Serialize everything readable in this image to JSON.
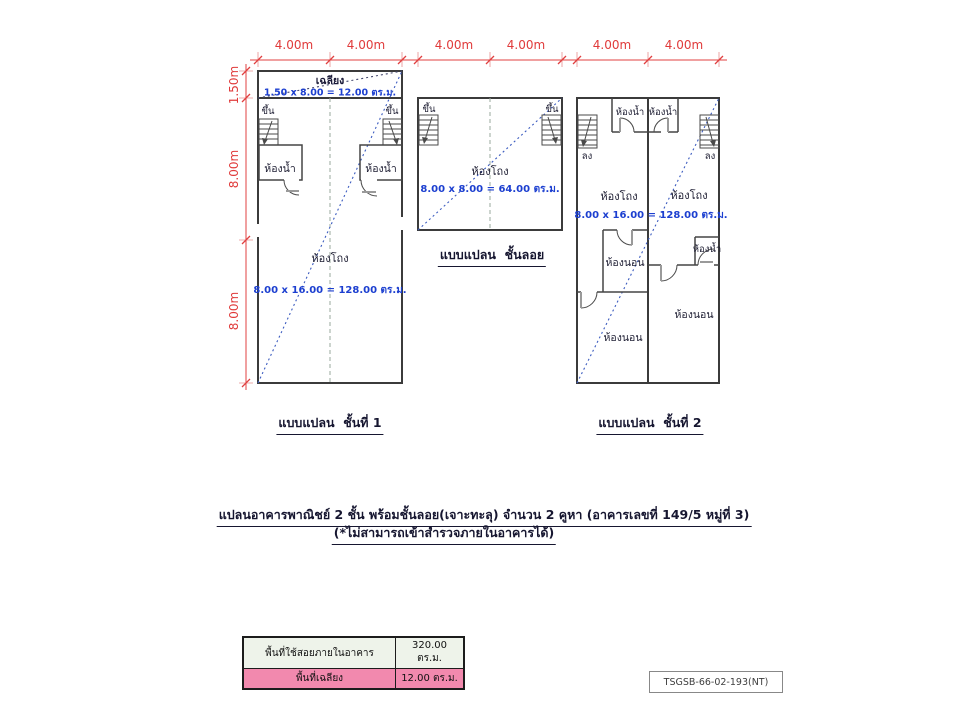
{
  "colors": {
    "plan_fill": "#e3f0e6",
    "porch_fill": "#ee87ae",
    "dimension_red": "#e04040",
    "area_text_blue": "#1c3fd0",
    "wall_dark": "#3b3b3b",
    "diagonal_blue": "#3c5cc0",
    "table_row_building_bg": "#eef3ea",
    "table_row_porch_bg": "#f289ae"
  },
  "dimensions": {
    "floor1": {
      "top": [
        "4.00m",
        "4.00m"
      ],
      "left": [
        "1.50m",
        "8.00m",
        "8.00m"
      ]
    },
    "mezzanine": {
      "top": [
        "4.00m",
        "4.00m"
      ]
    },
    "floor2": {
      "top": [
        "4.00m",
        "4.00m"
      ]
    }
  },
  "plans": {
    "floor1": {
      "caption": "แบบแปลน  ชั้นที่ 1",
      "porch_label": "เฉลียง",
      "porch_area": "1.50 x 8.00 = 12.00 ตร.ม.",
      "stair_up_left": "ขึ้น",
      "stair_up_right": "ขึ้น",
      "bathroom_left": "ห้องน้ำ",
      "bathroom_right": "ห้องน้ำ",
      "hall": "ห้องโถง",
      "hall_area": "8.00 x 16.00 = 128.00 ตร.ม."
    },
    "mezzanine": {
      "caption": "แบบแปลน  ชั้นลอย",
      "stair_up_left": "ขึ้น",
      "stair_up_right": "ขึ้น",
      "hall": "ห้องโถง",
      "hall_area": "8.00 x 8.00 = 64.00 ตร.ม."
    },
    "floor2": {
      "caption": "แบบแปลน  ชั้นที่ 2",
      "stair_down_left": "ลง",
      "stair_down_right": "ลง",
      "bathroom_top_left": "ห้องน้ำ",
      "bathroom_top_right": "ห้องน้ำ",
      "hall_left": "ห้องโถง",
      "hall_right": "ห้องโถง",
      "hall_area": "8.00 x 16.00 = 128.00 ตร.ม.",
      "bedroom_left_upper": "ห้องนอน",
      "bedroom_left_lower": "ห้องนอน",
      "bedroom_right": "ห้องนอน",
      "bathroom_right_small": "ห้องน้ำ"
    }
  },
  "title": {
    "line1": "แปลนอาคารพาณิชย์ 2 ชั้น พร้อมชั้นลอย(เจาะทะลุ) จำนวน 2 คูหา (อาคารเลขที่ 149/5 หมู่ที่ 3)",
    "line2": "(*ไม่สามารถเข้าสำรวจภายในอาคารได้)"
  },
  "summary_table": {
    "rows": [
      {
        "label": "พื้นที่ใช้สอยภายในอาคาร",
        "value": "320.00 ตร.ม."
      },
      {
        "label": "พื้นที่เฉลียง",
        "value": "12.00 ตร.ม."
      }
    ]
  },
  "doc_ref": "TSGSB-66-02-193(NT)"
}
